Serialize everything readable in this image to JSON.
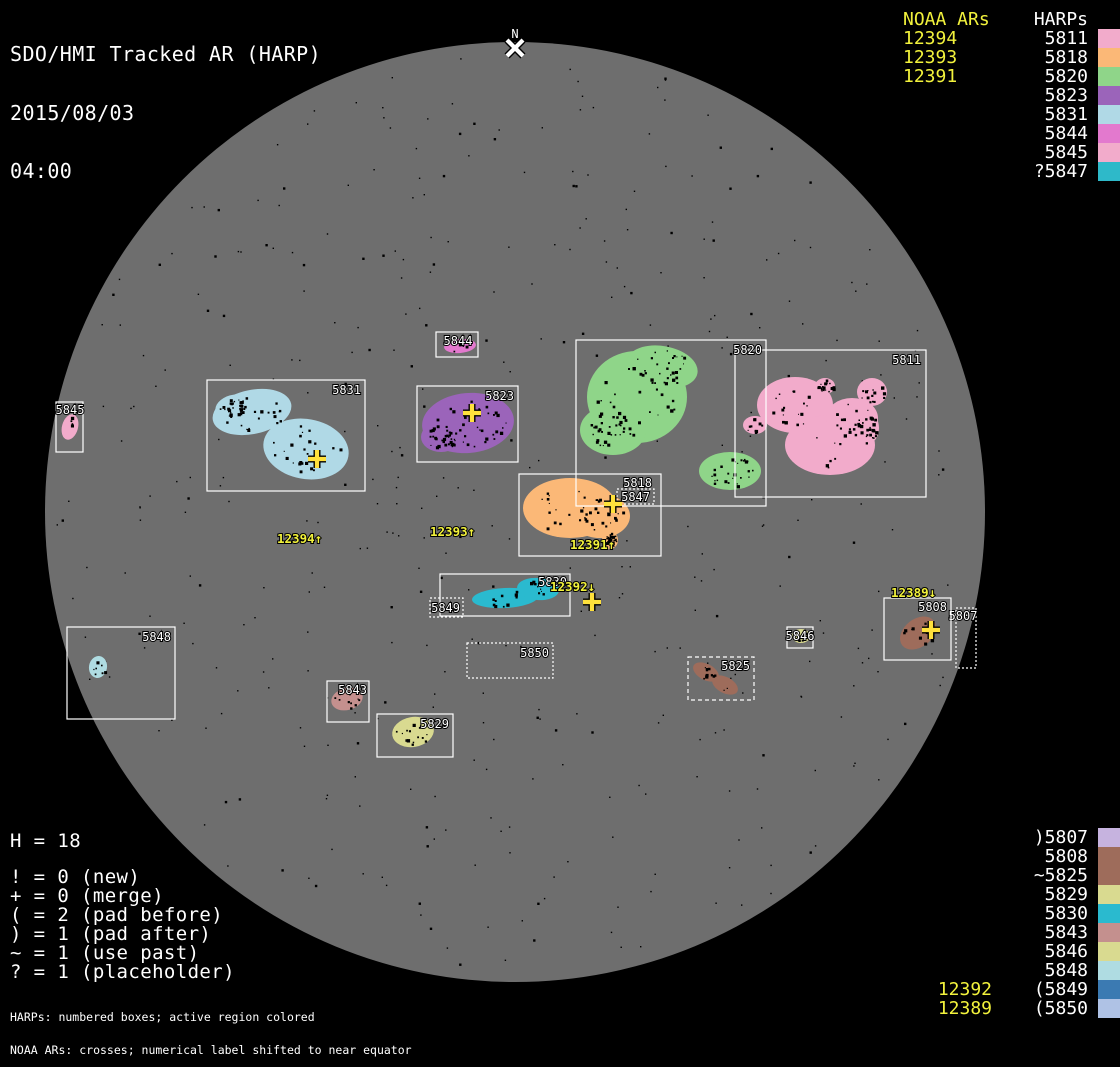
{
  "title": {
    "line1": "SDO/HMI Tracked AR (HARP)",
    "line2": "2015/08/03",
    "line3": "04:00"
  },
  "north_marker": {
    "label": "N",
    "x": 515,
    "y": 48
  },
  "legend_top": {
    "noaa_header": "NOAA ARs",
    "harp_header": "HARPs",
    "noaa": [
      "12394",
      "12393",
      "12391"
    ],
    "harps": [
      {
        "label": "5811",
        "color": "#F2ABCB"
      },
      {
        "label": "5818",
        "color": "#FBB877"
      },
      {
        "label": "5820",
        "color": "#8FD589"
      },
      {
        "label": "5823",
        "color": "#9B64BA"
      },
      {
        "label": "5831",
        "color": "#B0D9E6"
      },
      {
        "label": "5844",
        "color": "#E379CE"
      },
      {
        "label": "5845",
        "color": "#F2ABCB"
      },
      {
        "label": "?5847",
        "color": "#2EB9C9"
      }
    ]
  },
  "legend_bottom": {
    "harps": [
      {
        "label": ")5807",
        "color": "#C6B3DF"
      },
      {
        "label": "5808",
        "color": "#9E6C5B"
      },
      {
        "label": "~5825",
        "color": "#9E6C5B"
      },
      {
        "label": "5829",
        "color": "#D9DA90"
      },
      {
        "label": "5830",
        "color": "#2ABACF"
      },
      {
        "label": "5843",
        "color": "#C4908E"
      },
      {
        "label": "5846",
        "color": "#D9DA90"
      },
      {
        "label": "5848",
        "color": "#AFDCE2"
      },
      {
        "label": "(5849",
        "color": "#3B7AB2"
      },
      {
        "label": "(5850",
        "color": "#AFC2E5"
      }
    ],
    "noaa": [
      {
        "label": "12392",
        "align_row": 8
      },
      {
        "label": "12389",
        "align_row": 9
      }
    ]
  },
  "stats": {
    "h_line": "H = 18",
    "lines": [
      "! = 0 (new)",
      "+ = 0 (merge)",
      "( = 2 (pad before)",
      ") = 1 (pad after)",
      "~ = 1 (use past)",
      "? = 1 (placeholder)"
    ]
  },
  "footer": {
    "line1": "HARPs: numbered boxes; active region colored",
    "line2": "NOAA ARs: crosses; numerical label shifted to near equator"
  },
  "disk": {
    "color": "#6E6E6E",
    "cx": 515,
    "cy": 512,
    "r": 470
  },
  "colors": {
    "background": "#000000",
    "annotation_yellow": "#F2F23C",
    "cross_yellow": "#FFE13C",
    "box_white": "#FFFFFF"
  },
  "chart_data": {
    "type": "scatter",
    "title": "SDO/HMI Tracked AR (HARP)",
    "timestamp": "2015/08/03 04:00",
    "harp_count": 18,
    "harps": [
      {
        "harp": "5807",
        "box": [
          956,
          608,
          20,
          60
        ],
        "border": "dotted",
        "color": "#C6B3DF",
        "label_x": 963,
        "label_y": 620,
        "label_anchor": "middle",
        "ellipses": [],
        "speckles": 0
      },
      {
        "harp": "5808",
        "box": [
          884,
          598,
          67,
          62
        ],
        "border": "solid",
        "color": "#9E6C5B",
        "label_x": 947,
        "label_y": 611,
        "label_anchor": "end",
        "ellipses": [
          [
            918,
            633,
            20,
            14,
            -38
          ]
        ],
        "speckles": 12
      },
      {
        "harp": "5811",
        "box": [
          735,
          350,
          191,
          147
        ],
        "border": "solid",
        "color": "#F2ABCB",
        "label_x": 921,
        "label_y": 364,
        "label_anchor": "end",
        "ellipses": [
          [
            795,
            405,
            38,
            28,
            0
          ],
          [
            830,
            445,
            45,
            30,
            0
          ],
          [
            852,
            418,
            26,
            20,
            0
          ],
          [
            872,
            392,
            15,
            14,
            0
          ],
          [
            869,
            428,
            10,
            15,
            0
          ],
          [
            825,
            386,
            10,
            8,
            0
          ],
          [
            755,
            425,
            12,
            9,
            0
          ]
        ],
        "speckles": 110
      },
      {
        "harp": "5818",
        "box": [
          519,
          474,
          142,
          82
        ],
        "border": "solid",
        "color": "#FBB877",
        "label_x": 652,
        "label_y": 487,
        "label_anchor": "end",
        "ellipses": [
          [
            570,
            508,
            47,
            30,
            0
          ],
          [
            600,
            516,
            30,
            22,
            0
          ],
          [
            610,
            540,
            8,
            9,
            0
          ]
        ],
        "speckles": 70
      },
      {
        "harp": "5820",
        "box": [
          576,
          340,
          190,
          166
        ],
        "border": "solid",
        "color": "#8FD589",
        "label_x": 762,
        "label_y": 354,
        "label_anchor": "end",
        "ellipses": [
          [
            637,
            397,
            50,
            46,
            0
          ],
          [
            662,
            367,
            36,
            21,
            10
          ],
          [
            613,
            430,
            33,
            25,
            0
          ],
          [
            730,
            471,
            31,
            19,
            0
          ]
        ],
        "speckles": 110
      },
      {
        "harp": "5823",
        "box": [
          417,
          386,
          101,
          76
        ],
        "border": "solid",
        "color": "#9B64BA",
        "label_x": 514,
        "label_y": 400,
        "label_anchor": "end",
        "ellipses": [
          [
            468,
            423,
            46,
            30,
            -5
          ],
          [
            441,
            437,
            20,
            15,
            0
          ]
        ],
        "speckles": 65
      },
      {
        "harp": "5825",
        "box": [
          688,
          657,
          66,
          43
        ],
        "border": "dashed",
        "color": "#9E6C5B",
        "label_x": 750,
        "label_y": 670,
        "label_anchor": "end",
        "ellipses": [
          [
            706,
            672,
            14,
            8,
            28
          ],
          [
            725,
            685,
            14,
            8,
            28
          ]
        ],
        "speckles": 12
      },
      {
        "harp": "5829",
        "box": [
          377,
          714,
          76,
          43
        ],
        "border": "solid",
        "color": "#D9DA90",
        "label_x": 449,
        "label_y": 728,
        "label_anchor": "end",
        "ellipses": [
          [
            413,
            732,
            21,
            15,
            -10
          ]
        ],
        "speckles": 16
      },
      {
        "harp": "5830",
        "box": [
          440,
          574,
          130,
          42
        ],
        "border": "solid",
        "color": "#2ABACF",
        "label_x": 567,
        "label_y": 586,
        "label_anchor": "end",
        "ellipses": [
          [
            505,
            598,
            33,
            10,
            -3
          ],
          [
            538,
            589,
            21,
            11,
            5
          ]
        ],
        "speckles": 25
      },
      {
        "harp": "5831",
        "box": [
          207,
          380,
          158,
          111
        ],
        "border": "solid",
        "color": "#B0D9E6",
        "label_x": 361,
        "label_y": 394,
        "label_anchor": "end",
        "ellipses": [
          [
            252,
            412,
            40,
            22,
            -12
          ],
          [
            306,
            449,
            43,
            30,
            10
          ],
          [
            233,
            407,
            18,
            12,
            -15
          ]
        ],
        "speckles": 75
      },
      {
        "harp": "5843",
        "box": [
          327,
          681,
          42,
          41
        ],
        "border": "solid",
        "color": "#C4908E",
        "label_x": 367,
        "label_y": 694,
        "label_anchor": "end",
        "ellipses": [
          [
            347,
            699,
            16,
            11,
            -15
          ]
        ],
        "speckles": 10
      },
      {
        "harp": "5844",
        "box": [
          436,
          332,
          42,
          25
        ],
        "border": "solid",
        "color": "#E379CE",
        "label_x": 458,
        "label_y": 345,
        "label_anchor": "middle",
        "ellipses": [
          [
            460,
            346,
            16,
            7,
            -5
          ]
        ],
        "speckles": 5
      },
      {
        "harp": "5845",
        "box": [
          56,
          402,
          27,
          50
        ],
        "border": "solid",
        "color": "#F2ABCB",
        "label_x": 70,
        "label_y": 414,
        "label_anchor": "middle",
        "ellipses": [
          [
            70,
            427,
            8,
            13,
            15
          ]
        ],
        "speckles": 4
      },
      {
        "harp": "5846",
        "box": [
          787,
          627,
          26,
          21
        ],
        "border": "solid",
        "color": "#D9DA90",
        "label_x": 800,
        "label_y": 640,
        "label_anchor": "middle",
        "ellipses": [
          [
            801,
            636,
            9,
            7,
            0
          ]
        ],
        "speckles": 4
      },
      {
        "harp": "5847",
        "box": [
          617,
          489,
          37,
          15
        ],
        "border": "dotted",
        "color": "#2EB9C9",
        "label_x": 650,
        "label_y": 501,
        "label_anchor": "end",
        "ellipses": [],
        "speckles": 0
      },
      {
        "harp": "5848",
        "box": [
          67,
          627,
          108,
          92
        ],
        "border": "solid",
        "color": "#AFDCE2",
        "label_x": 171,
        "label_y": 641,
        "label_anchor": "end",
        "ellipses": [
          [
            98,
            667,
            9,
            11,
            10
          ]
        ],
        "speckles": 7
      },
      {
        "harp": "5849",
        "box": [
          430,
          598,
          33,
          19
        ],
        "border": "dotted",
        "color": "#3B7AB2",
        "label_x": 460,
        "label_y": 612,
        "label_anchor": "end",
        "ellipses": [],
        "speckles": 0
      },
      {
        "harp": "5850",
        "box": [
          467,
          643,
          86,
          35
        ],
        "border": "dotted",
        "color": "#AFC2E5",
        "label_x": 549,
        "label_y": 657,
        "label_anchor": "end",
        "ellipses": [],
        "speckles": 0
      }
    ],
    "noaa_crosses": [
      {
        "ar": "12394",
        "x": 317,
        "y": 459
      },
      {
        "ar": "12393",
        "x": 472,
        "y": 413
      },
      {
        "ar": "12391",
        "x": 613,
        "y": 504
      },
      {
        "ar": "12392",
        "x": 592,
        "y": 602
      },
      {
        "ar": "12389",
        "x": 931,
        "y": 630
      }
    ],
    "noaa_shifted_labels": [
      {
        "text": "12394↑",
        "ar": "12394",
        "x": 277,
        "y": 543
      },
      {
        "text": "12393↑",
        "ar": "12393",
        "x": 430,
        "y": 536
      },
      {
        "text": "12391↑",
        "ar": "12391",
        "x": 570,
        "y": 549
      },
      {
        "text": "12392↓",
        "ar": "12392",
        "x": 550,
        "y": 591
      },
      {
        "text": "12389↓",
        "ar": "12389",
        "x": 891,
        "y": 597
      }
    ]
  }
}
